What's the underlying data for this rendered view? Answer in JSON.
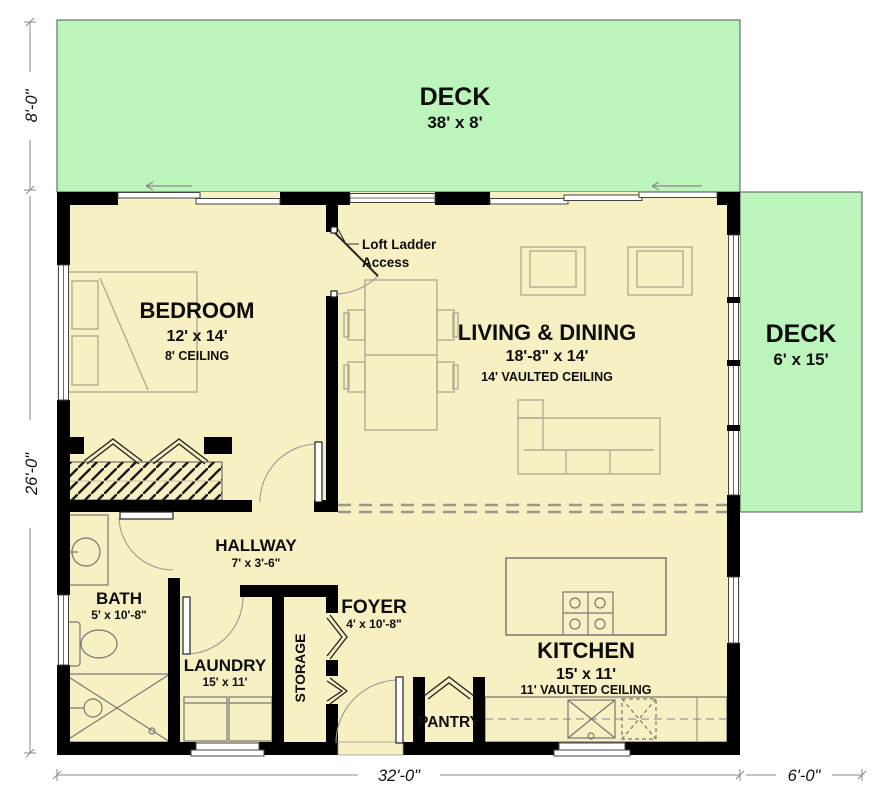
{
  "plan": {
    "decks": {
      "top": {
        "name": "DECK",
        "size": "38' x 8'"
      },
      "right": {
        "name": "DECK",
        "size": "6' x 15'"
      }
    },
    "rooms": {
      "bedroom": {
        "name": "BEDROOM",
        "size": "12' x 14'",
        "ceiling": "8' CEILING"
      },
      "living_dining": {
        "name": "LIVING & DINING",
        "size": "18'-8\" x 14'",
        "ceiling": "14' VAULTED CEILING"
      },
      "kitchen": {
        "name": "KITCHEN",
        "size": "15' x 11'",
        "ceiling": "11' VAULTED CEILING"
      },
      "hallway": {
        "name": "HALLWAY",
        "size": "7' x 3'-6\""
      },
      "bath": {
        "name": "BATH",
        "size": "5' x 10'-8\""
      },
      "laundry": {
        "name": "LAUNDRY",
        "size": "15' x 11'"
      },
      "foyer": {
        "name": "FOYER",
        "size": "4' x 10'-8\""
      },
      "storage": {
        "name": "STORAGE"
      },
      "pantry": {
        "name": "PANTRY"
      }
    },
    "annotations": {
      "loft_ladder_line1": "Loft Ladder",
      "loft_ladder_line2": "Access"
    },
    "dimensions": {
      "left_top": "8'-0\"",
      "left_bottom": "26'-0\"",
      "bottom_main": "32'-0\"",
      "bottom_right": "6'-0\""
    },
    "colors": {
      "deck": "#bcf5bb",
      "floor": "#f6f0c2",
      "wall": "#000000"
    }
  }
}
